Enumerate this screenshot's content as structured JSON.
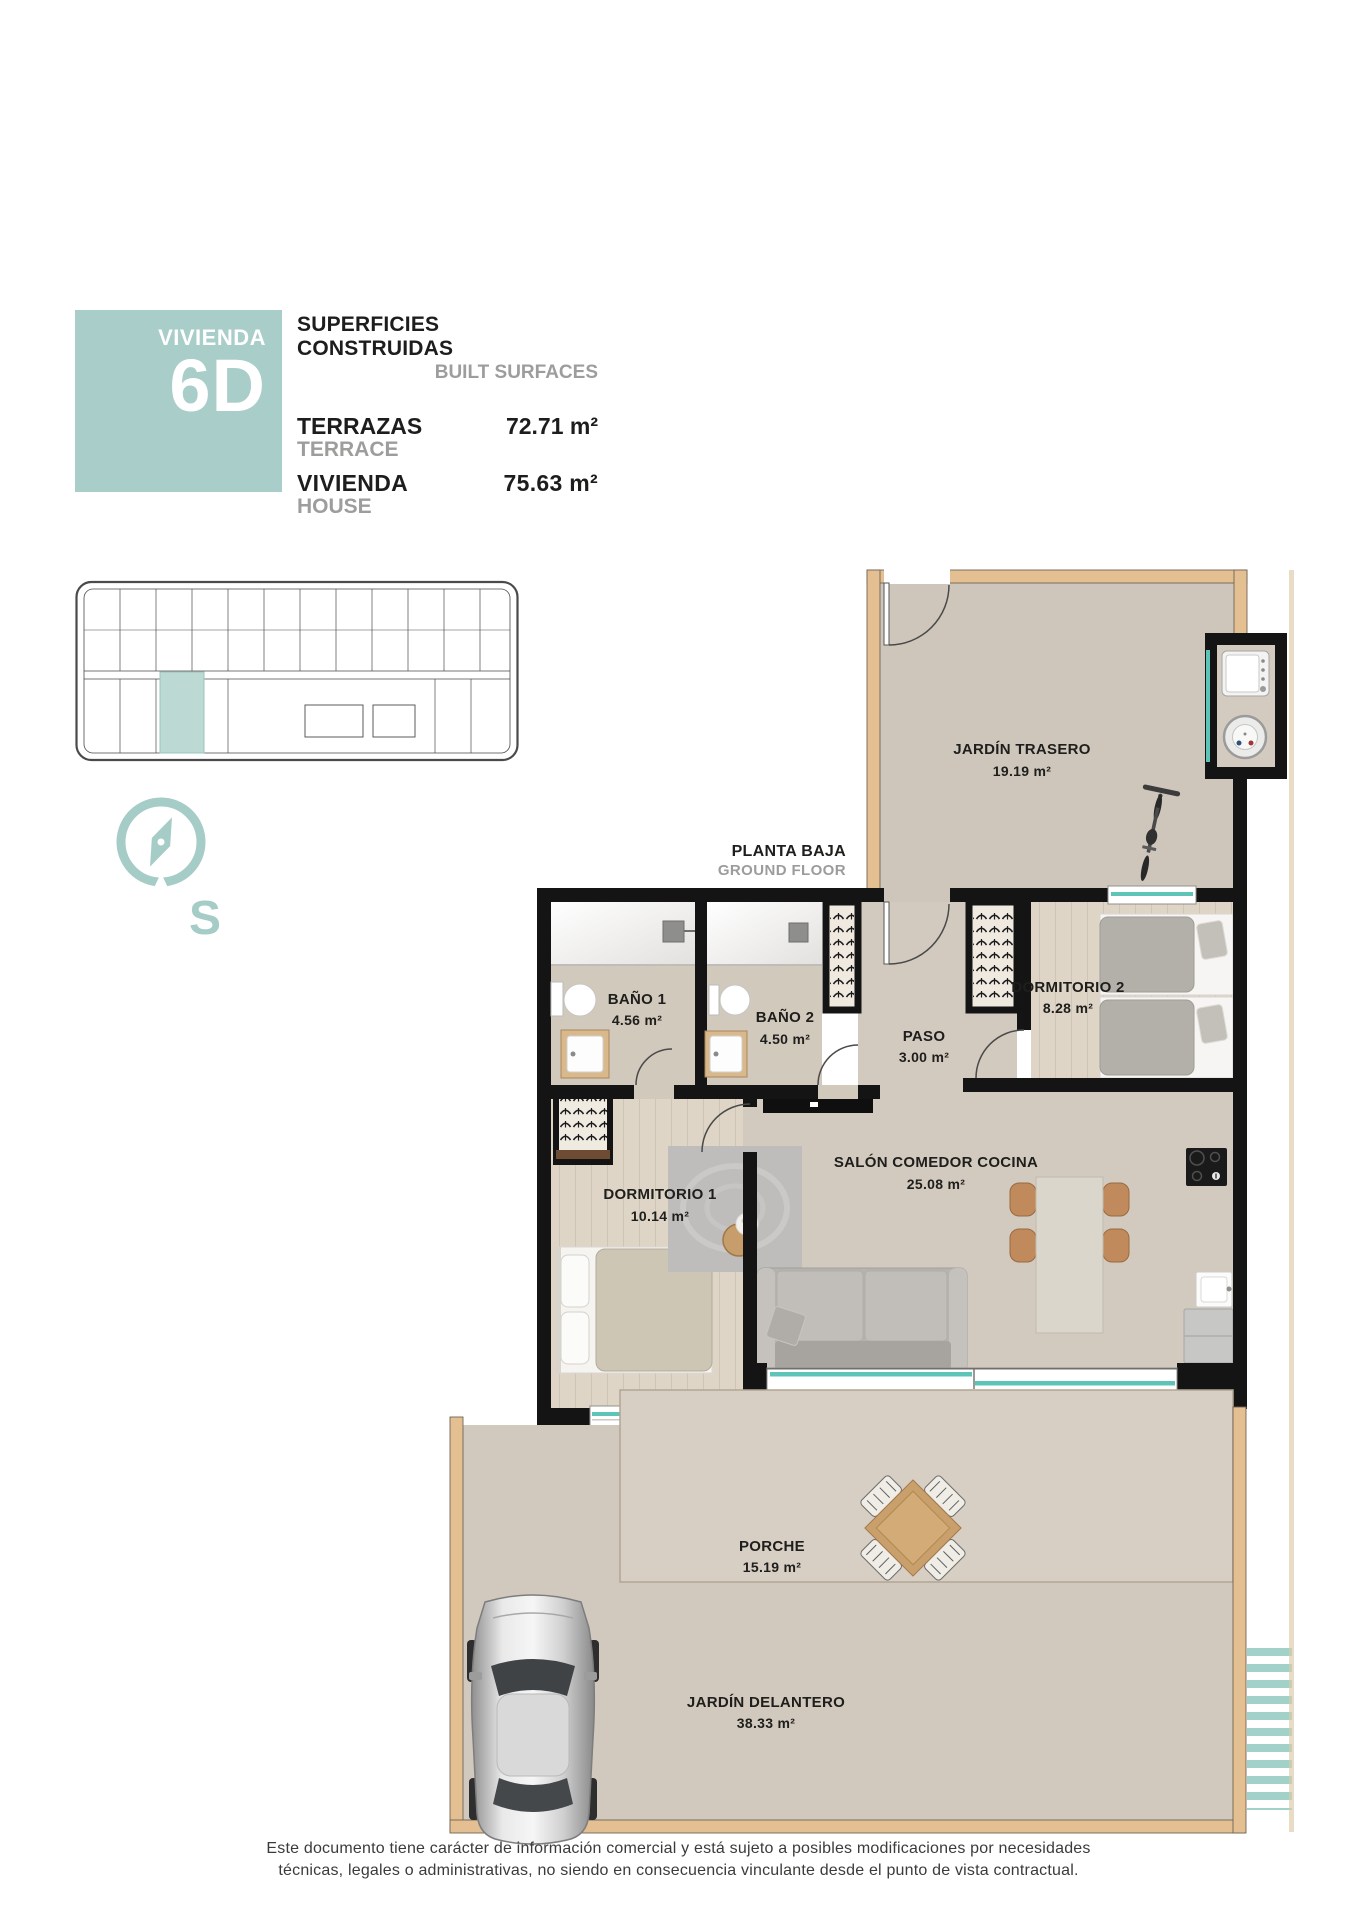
{
  "header": {
    "unit_label": "VIVIENDA",
    "unit_code": "6D",
    "surfaces_title_es": "SUPERFICIES CONSTRUIDAS",
    "surfaces_title_en": "BUILT SURFACES",
    "terrace_label_es": "TERRAZAS",
    "terrace_label_en": "TERRACE",
    "terrace_value": "72.71 m²",
    "house_label_es": "VIVIENDA",
    "house_label_en": "HOUSE",
    "house_value": "75.63 m²"
  },
  "plan": {
    "floor_label_es": "PLANTA BAJA",
    "floor_label_en": "GROUND FLOOR",
    "compass_letter": "S",
    "rooms": [
      {
        "name": "JARDÍN TRASERO",
        "area": "19.19 m²"
      },
      {
        "name": "BAÑO 1",
        "area": "4.56 m²"
      },
      {
        "name": "BAÑO 2",
        "area": "4.50 m²"
      },
      {
        "name": "PASO",
        "area": "3.00 m²"
      },
      {
        "name": "DORMITORIO 2",
        "area": "8.28 m²"
      },
      {
        "name": "SALÓN COMEDOR COCINA",
        "area": "25.08 m²"
      },
      {
        "name": "DORMITORIO 1",
        "area": "10.14 m²"
      },
      {
        "name": "PORCHE",
        "area": "15.19 m²"
      },
      {
        "name": "JARDÍN DELANTERO",
        "area": "38.33 m²"
      }
    ]
  },
  "footer": {
    "disclaimer_line1": "Este documento tiene carácter de información comercial y está sujeto a posibles modificaciones por necesidades",
    "disclaimer_line2": "técnicas, legales o administrativas, no siendo en consecuencia vinculante desde el punto de vista contractual."
  },
  "colors": {
    "accent_teal": "#a9cdc9",
    "window_teal": "#5fc4b8",
    "wall_black": "#141414",
    "garden_wall_tan": "#e4bf92",
    "muted_gray": "#9d9d9c"
  }
}
